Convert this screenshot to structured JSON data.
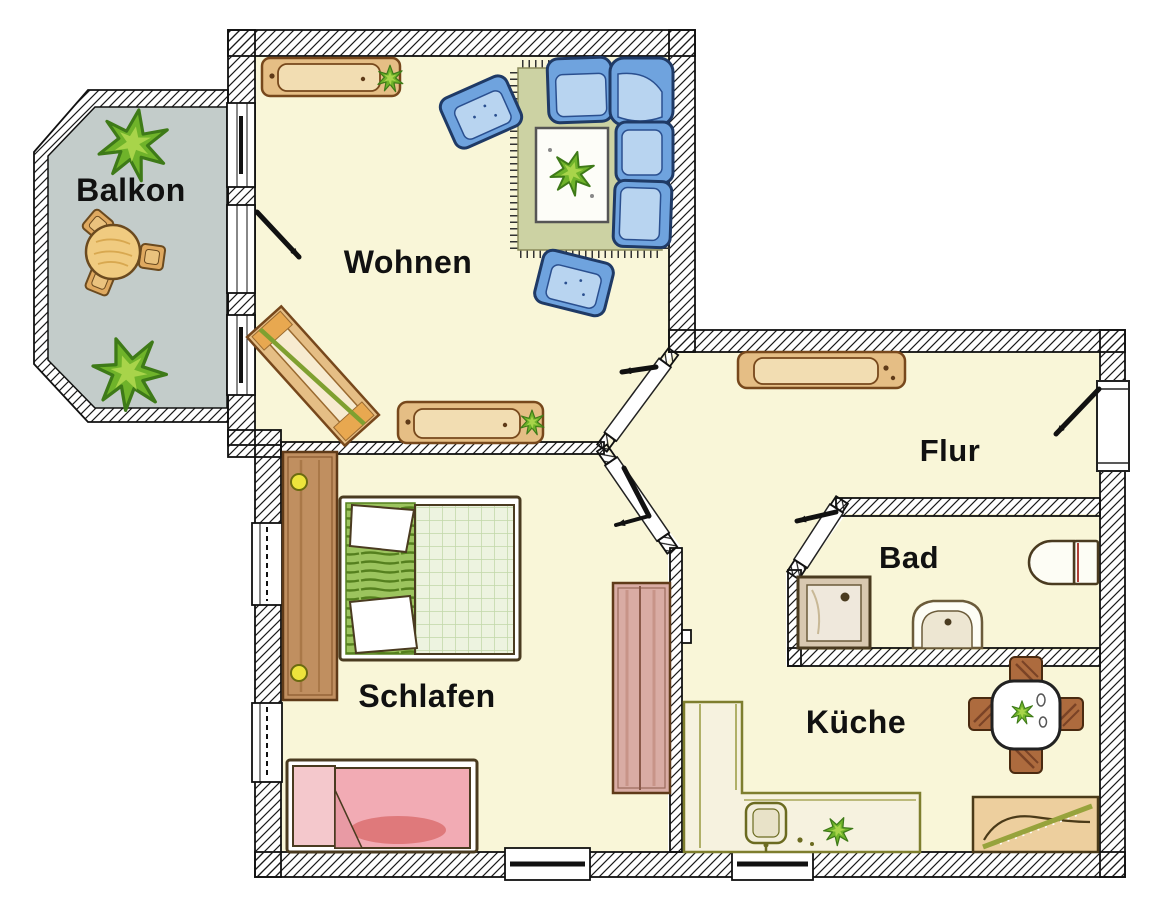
{
  "room_labels": {
    "balkon": "Balkon",
    "wohnen": "Wohnen",
    "flur": "Flur",
    "bad": "Bad",
    "schlafen": "Schlafen",
    "kueche": "Küche"
  },
  "palette": {
    "floor_cream": "#F9F6D8",
    "balcony_floor_gray": "#C3CCCA",
    "wall_line": "#111111",
    "wood_tan": "#E5BE85",
    "wood_inner": "#F2DDB2",
    "wood_border": "#77481C",
    "sofa_blue": "#6FA3DE",
    "sofa_cushion": "#B8D4F0",
    "sofa_border": "#1F3A66",
    "rug_green": "#CCD2A3",
    "bed_pleat_green": "#9CC45E",
    "blanket_green": "#EDF3E0",
    "blanket_pink": "#F2ABB4",
    "pillow_red": "#D86868",
    "plant_green": "#6FB32A",
    "knob_yellow": "#EDE43C",
    "counter_border": "#7E7E2E",
    "chair_brown": "#AD6B3E",
    "wardrobe_brown": "#C08F60",
    "cabinet_rose": "#D9ACA4"
  },
  "rooms": [
    {
      "id": "balkon",
      "label": "Balkon",
      "furniture": [
        "round-table",
        "stool",
        "stool",
        "stool",
        "plant",
        "plant"
      ]
    },
    {
      "id": "wohnen",
      "label": "Wohnen",
      "furniture": [
        "sideboard",
        "armchair",
        "armchair",
        "corner-sofa",
        "rug",
        "coffee-table",
        "plant",
        "angled-shelf",
        "lowboard"
      ],
      "openings": [
        "balcony-door",
        "balcony-window",
        "balcony-window",
        "door-to-flur"
      ]
    },
    {
      "id": "flur",
      "label": "Flur",
      "furniture": [
        "sideboard"
      ],
      "openings": [
        "entrance-door"
      ]
    },
    {
      "id": "bad",
      "label": "Bad",
      "furniture": [
        "shower",
        "washbasin",
        "toilet"
      ],
      "openings": [
        "door"
      ]
    },
    {
      "id": "schlafen",
      "label": "Schlafen",
      "furniture": [
        "wardrobe",
        "double-bed",
        "single-bed",
        "tall-cabinet"
      ],
      "openings": [
        "door",
        "window",
        "window",
        "window"
      ]
    },
    {
      "id": "kueche",
      "label": "Küche",
      "furniture": [
        "kitchen-counter",
        "kitchen-sink",
        "dining-table",
        "chair",
        "chair",
        "chair",
        "chair",
        "bench",
        "plant"
      ],
      "openings": [
        "window"
      ]
    }
  ]
}
